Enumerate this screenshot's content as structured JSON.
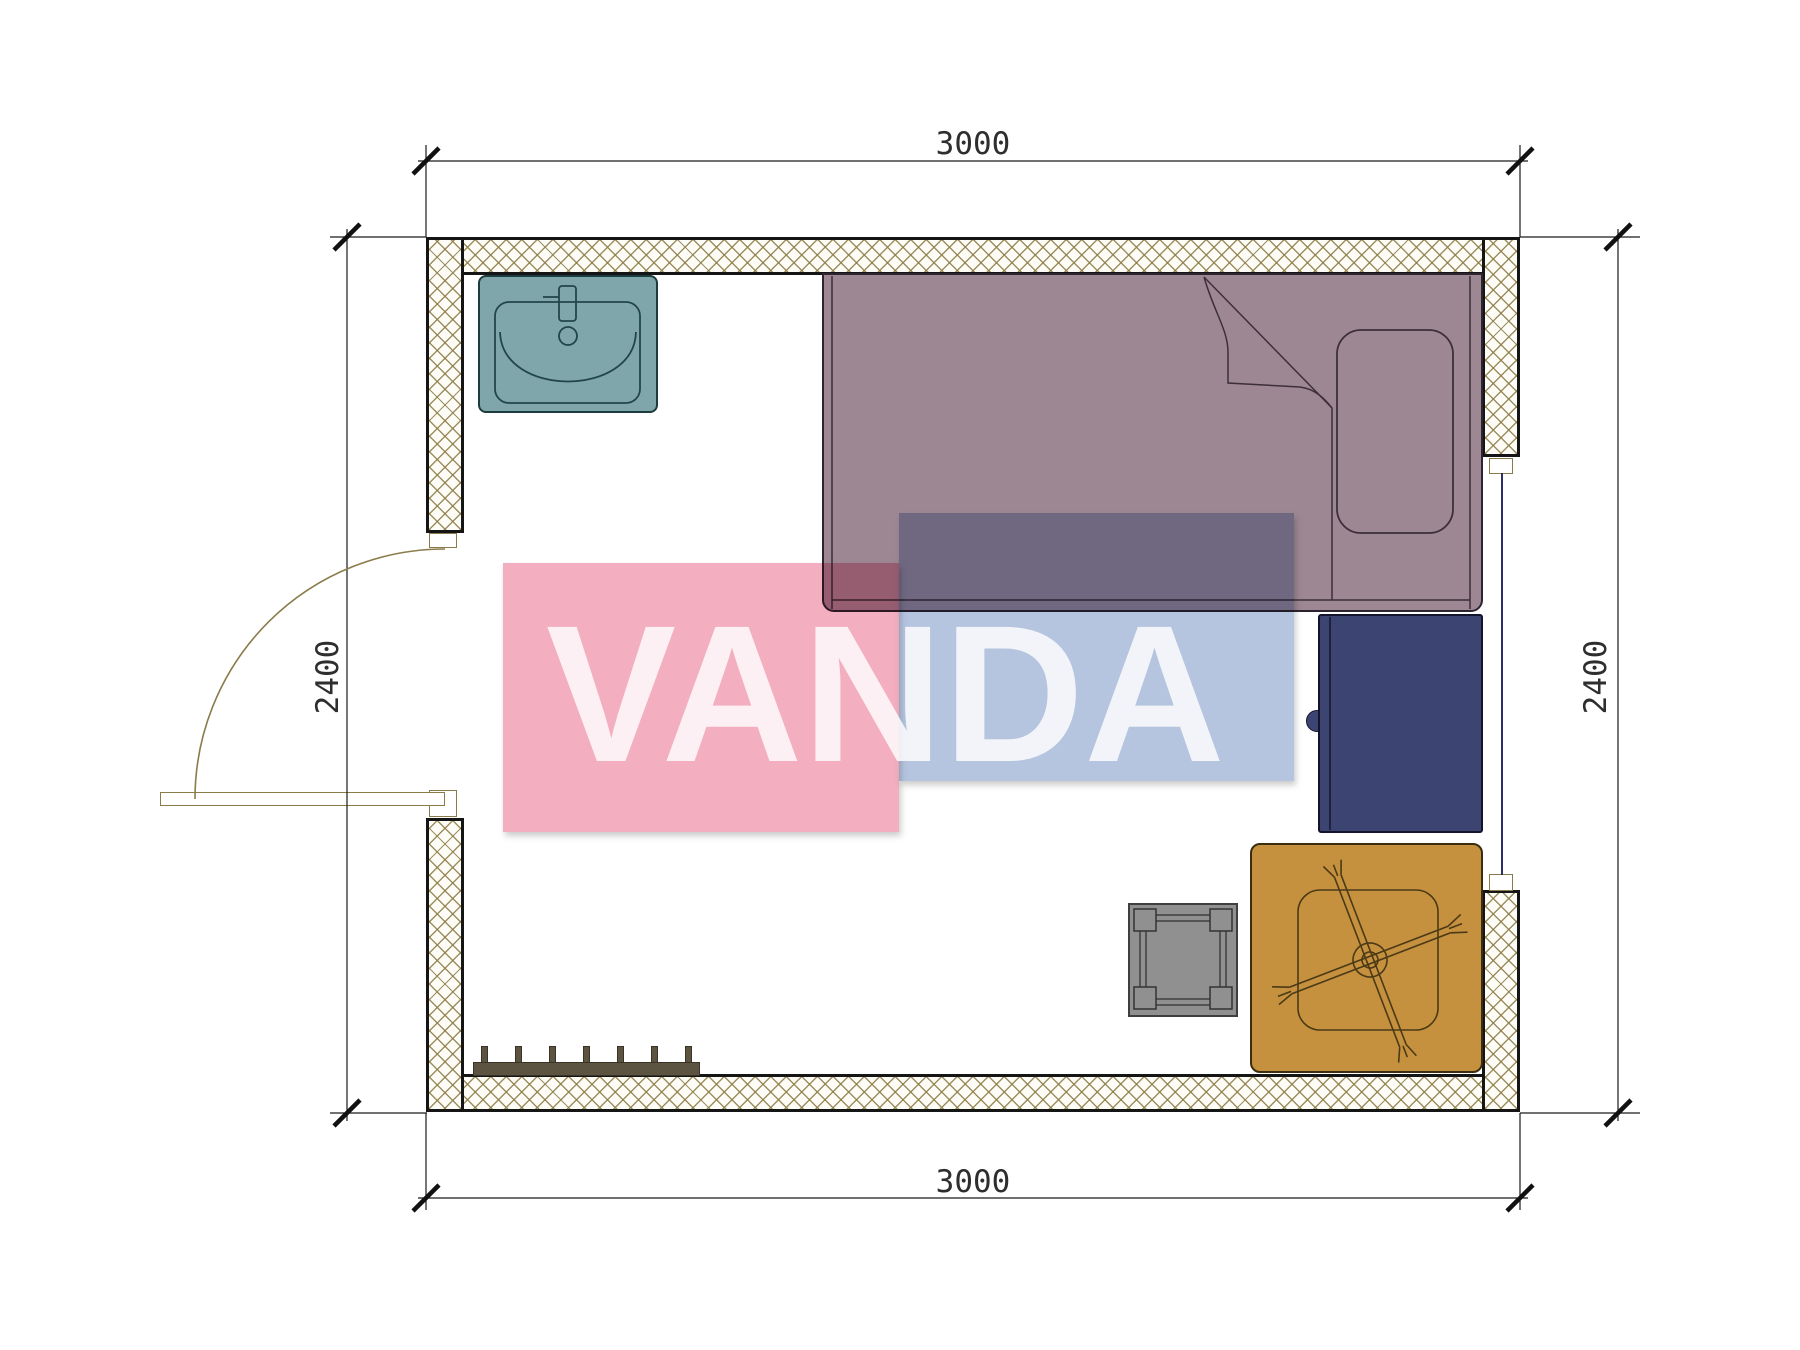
{
  "dimensions": {
    "top": "3000",
    "bottom": "3000",
    "left": "2400",
    "right": "2400"
  },
  "watermark": {
    "text": "VANDA",
    "pink_color": "#F3AEC0",
    "blue_color": "#B5C4DF"
  },
  "colors": {
    "wall_hatch_line": "#8b7c46",
    "wall_border": "#151515",
    "sink_fill": "#7FA7AB",
    "sink_line": "#23454a",
    "bed_fill": "#9D8793",
    "bed_line": "#3d2f3a",
    "desk_fill": "#3C4471",
    "table_fill": "#C6913E",
    "table_line": "#4a3a16",
    "stool_fill": "#909090",
    "stool_line": "#3f3f3f",
    "rack_fill": "#5C5340",
    "door_line": "#8a7b4a",
    "window_line": "#2d2d6b",
    "dim_color": "#2e2e2e"
  }
}
